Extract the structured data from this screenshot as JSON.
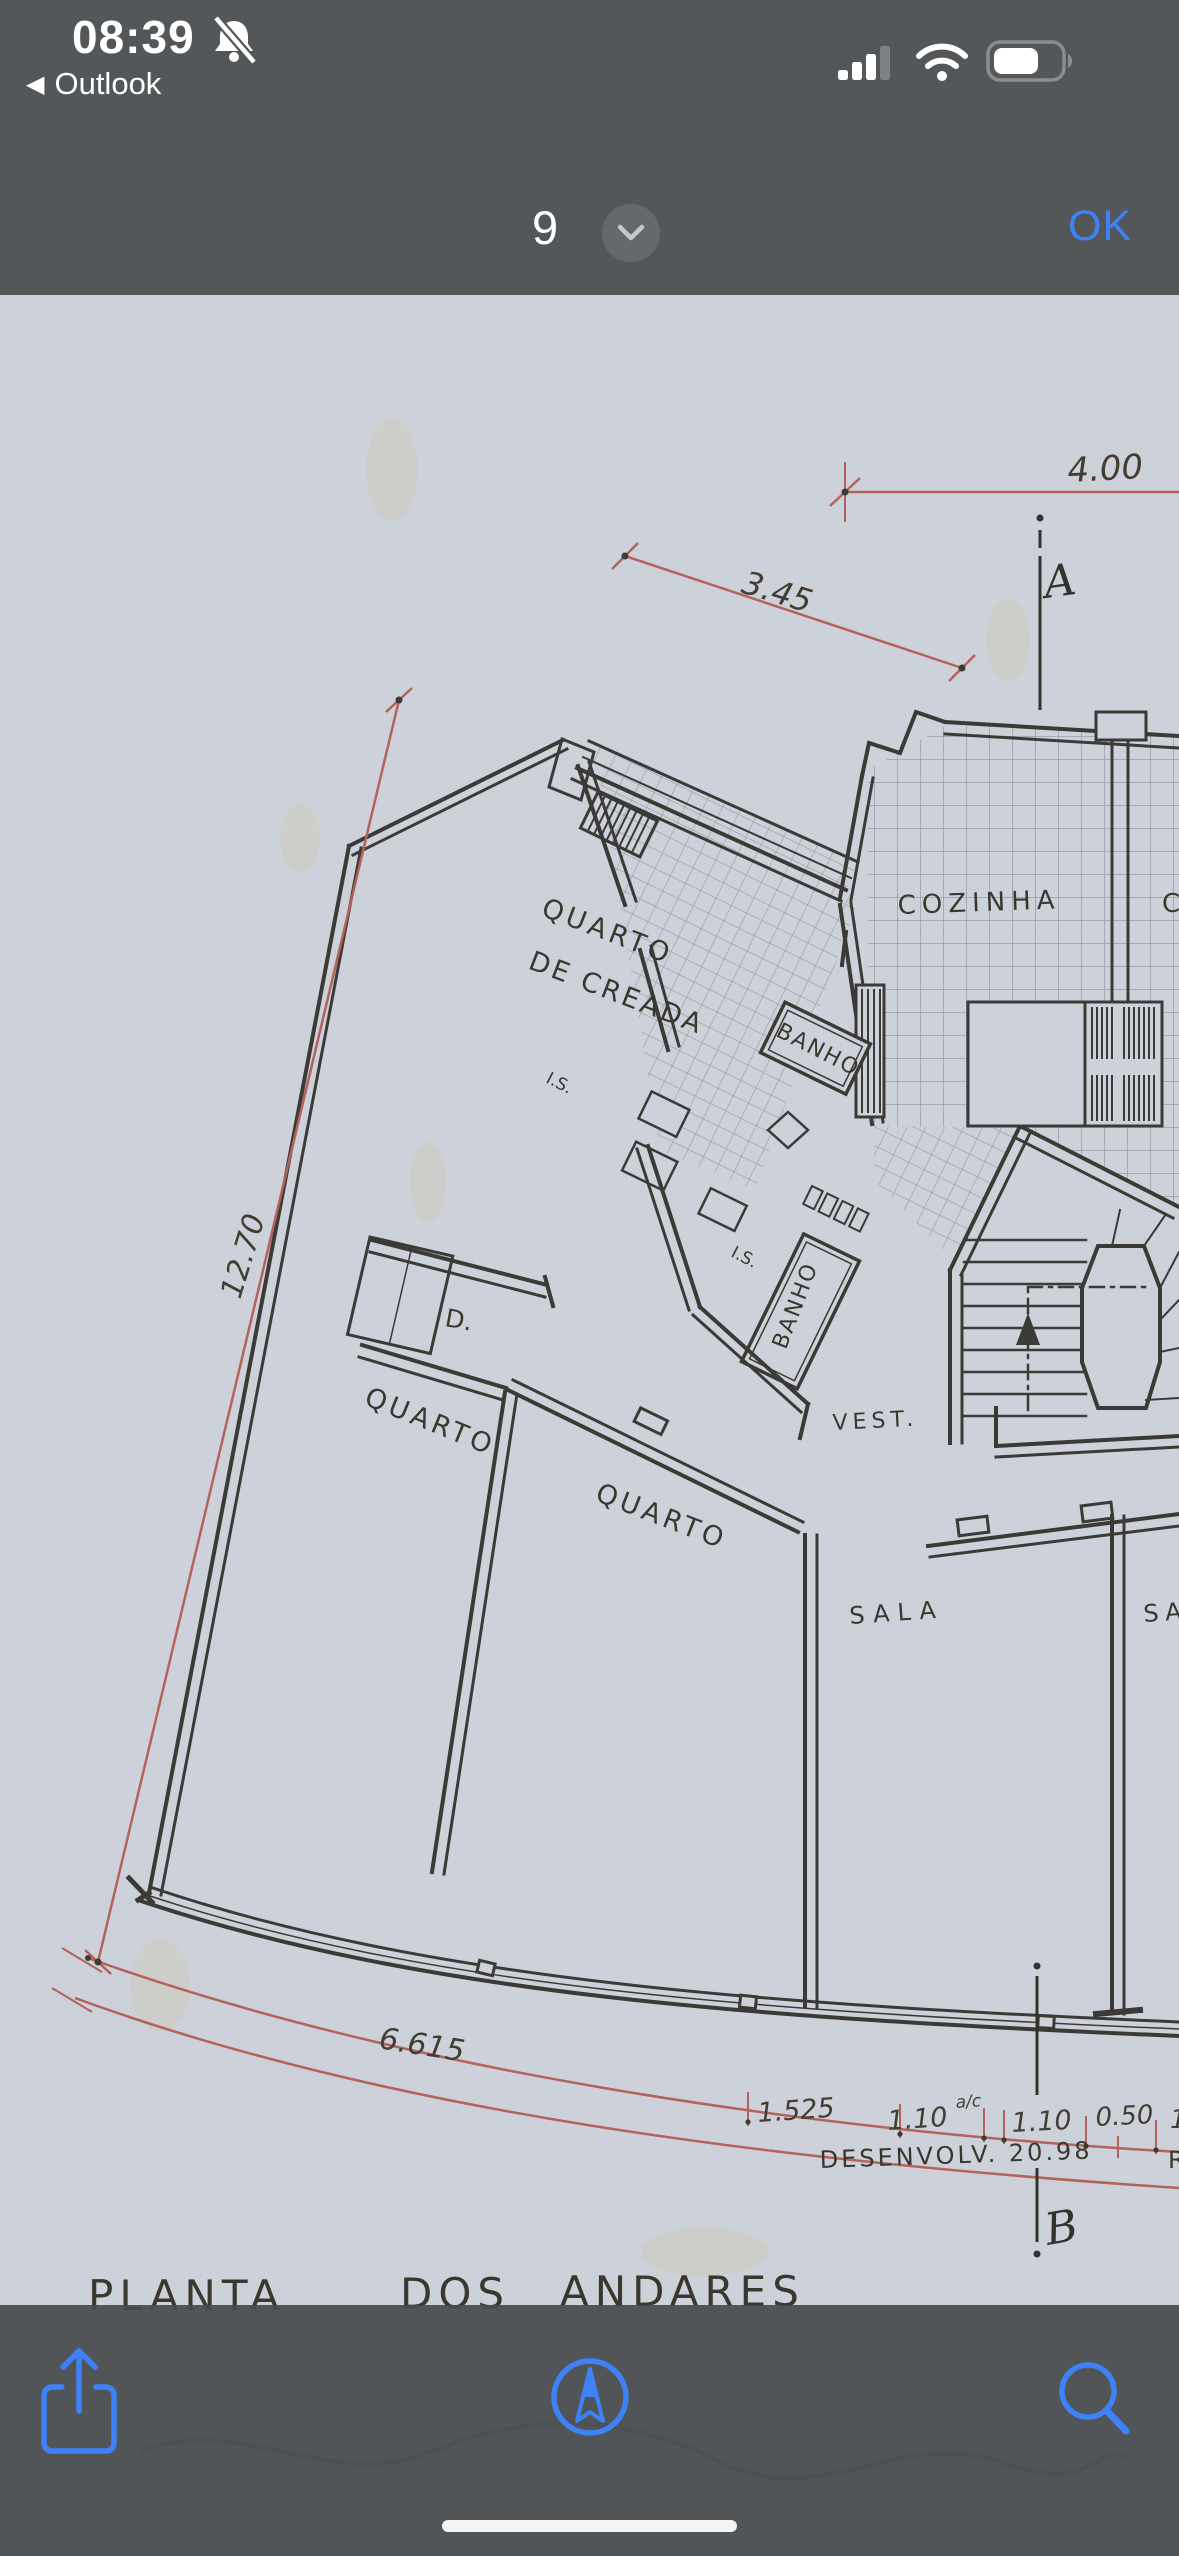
{
  "status_bar": {
    "time": "08:39",
    "back_chevron": "◀",
    "back_app": "Outlook"
  },
  "nav_bar": {
    "page_indicator": "9",
    "ok_label": "OK"
  },
  "plan": {
    "labels": {
      "dim400": "4.00",
      "dim345": "3.45",
      "dim1270": "12.70",
      "dim6615": "6.615",
      "chain1": "1.525",
      "chain2": "1.10",
      "chain_sup": "a/c",
      "chain3": "1.10",
      "chain4": "0.50",
      "chain5": "1.",
      "desenv": "DESENVOLV. 20.98",
      "desenv_partial": "R",
      "axisA": "A",
      "axisB": "B",
      "quarto_creada1": "QUARTO",
      "quarto_creada2": "DE CREADA",
      "banho1": "BANHO",
      "banho2": "BANHO",
      "is1": "I.S.",
      "is2": "I.S.",
      "cozinha": "COZINHA",
      "cozinha_partial": "C",
      "d_closet": "D.",
      "quarto1": "QUARTO",
      "quarto2": "QUARTO",
      "vest": "VEST.",
      "sala1": "SALA",
      "sala2": "SA",
      "title1": "PLANTA",
      "title2": "DOS",
      "title3": "ANDARES"
    }
  },
  "colors": {
    "accent_blue": "#3E82F8",
    "dimension_red": "#B4635A",
    "paper": "#CDD1D9",
    "chrome_bg": "#545759",
    "ink": "#3B3A36"
  }
}
